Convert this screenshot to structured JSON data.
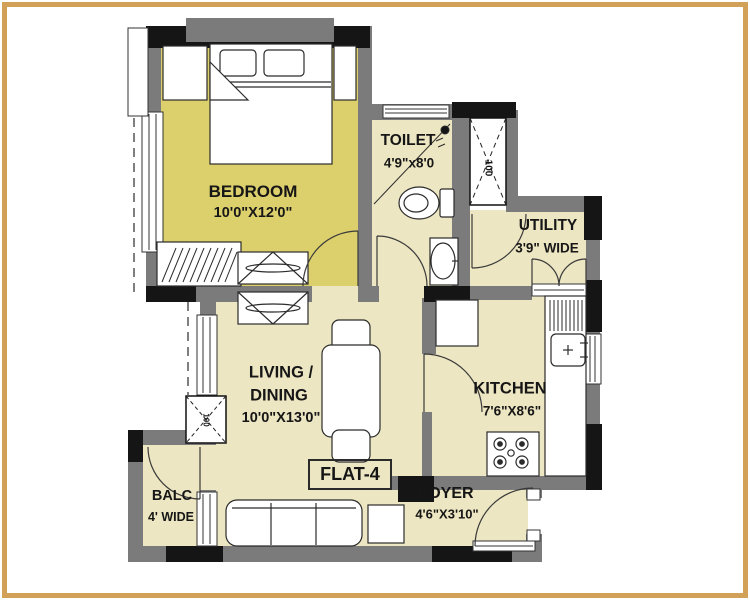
{
  "plan": {
    "flat_label": "FLAT-4",
    "rooms": {
      "bedroom": {
        "name": "BEDROOM",
        "dims": "10'0\"X12'0\""
      },
      "toilet": {
        "name": "TOILET",
        "dims": "4'9\"x8'0"
      },
      "utility": {
        "name": "UTILITY",
        "dims": "3'9\" WIDE"
      },
      "living": {
        "name_line1": "LIVING /",
        "name_line2": "DINING",
        "dims": "10'0\"X13'0\""
      },
      "kitchen": {
        "name": "KITCHEN",
        "dims": "7'6\"X8'6\""
      },
      "foyer": {
        "name": "FOYER",
        "dims": "4'6\"X3'10\""
      },
      "balcony": {
        "name": "BALC",
        "dims": "4' WIDE"
      }
    },
    "ducts": {
      "duct1": "100",
      "duct2": "100"
    },
    "colors": {
      "page_border": "#d0a156",
      "bedroom_fill": "#dcd06d",
      "room_fill": "#ece6c2",
      "wall_gray": "#7b7b7b",
      "wall_black": "#151515"
    }
  }
}
